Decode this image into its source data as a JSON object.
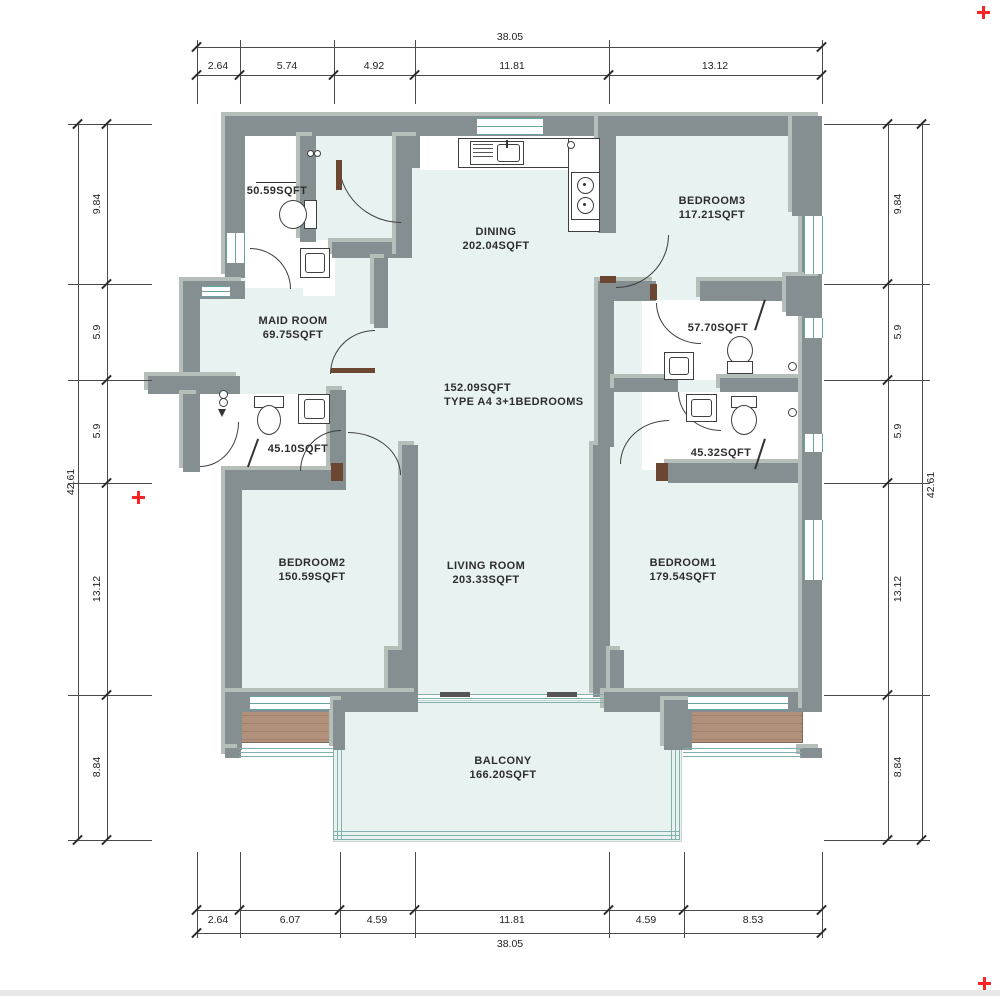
{
  "plan": {
    "foyer": {
      "line1": "152.09SQFT",
      "line2": "TYPE A4 3+1BEDROOMS"
    },
    "rooms": [
      {
        "id": "dining",
        "name": "DINING",
        "area": "202.04SQFT"
      },
      {
        "id": "bedroom3",
        "name": "BEDROOM3",
        "area": "117.21SQFT"
      },
      {
        "id": "maid-room",
        "name": "MAID ROOM",
        "area": "69.75SQFT"
      },
      {
        "id": "living-room",
        "name": "LIVING ROOM",
        "area": "203.33SQFT"
      },
      {
        "id": "bedroom2",
        "name": "BEDROOM2",
        "area": "150.59SQFT"
      },
      {
        "id": "bedroom1",
        "name": "BEDROOM1",
        "area": "179.54SQFT"
      },
      {
        "id": "balcony",
        "name": "BALCONY",
        "area": "166.20SQFT"
      }
    ],
    "bathrooms": [
      {
        "id": "bath-entry",
        "area": "50.59SQFT"
      },
      {
        "id": "bath-upper-right",
        "area": "57.70SQFT"
      },
      {
        "id": "bath-left",
        "area": "45.10SQFT"
      },
      {
        "id": "bath-lower-right",
        "area": "45.32SQFT"
      }
    ]
  },
  "dimensions": {
    "top": {
      "total": "38.05",
      "segments": [
        "2.64",
        "5.74",
        "4.92",
        "11.81",
        "13.12"
      ]
    },
    "bottom": {
      "total": "38.05",
      "segments": [
        "2.64",
        "6.07",
        "4.59",
        "11.81",
        "4.59",
        "8.53"
      ]
    },
    "left": {
      "total": "42.61",
      "segments": [
        "9.84",
        "5.9",
        "5.9",
        "13.12",
        "8.84"
      ]
    },
    "right": {
      "total": "42.61",
      "segments": [
        "9.84",
        "5.9",
        "5.9",
        "13.12",
        "8.84"
      ]
    }
  },
  "colors": {
    "wall": "#858e90",
    "wall_light": "#b6beba",
    "floor": "#e8f2f0",
    "bath_floor": "#ffffff",
    "wood_deck": "#b1907c",
    "window_glass": "#68a2a2",
    "balcony_glass": "#82b1ad",
    "door_jamb": "#6b4631",
    "marker_red": "#fb2424",
    "dim_line": "#4a4a4a"
  }
}
